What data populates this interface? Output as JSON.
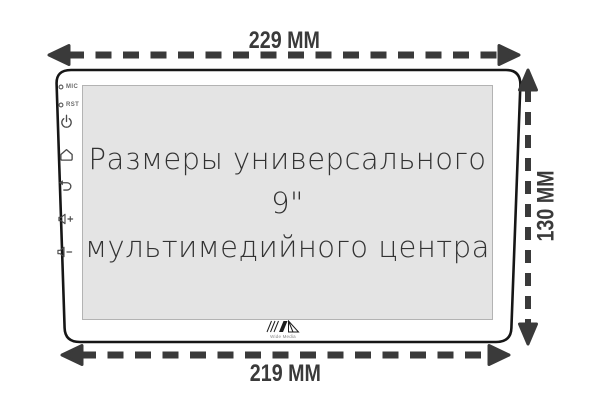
{
  "diagram": {
    "title": "Размеры универсального 9\" мультимедийного центра",
    "dimensions": {
      "top": "229 MM",
      "bottom": "219 MM",
      "right": "130 MM"
    },
    "screen_caption": {
      "line1": "Размеры универсального 9\"",
      "line2": "мультимедийного центра"
    },
    "bezel": {
      "mic_label": "MIC",
      "rst_label": "RST",
      "icons": [
        "mic-led",
        "reset-led",
        "power",
        "home",
        "back",
        "volume-up",
        "volume-down"
      ]
    },
    "logo": {
      "text": "Wide Media"
    },
    "colors": {
      "dimension": "#3a3a3a",
      "device_outline": "#161616",
      "screen_fill": "#e4e4e4",
      "screen_border": "#b3b3b3",
      "caption_text": "#323232",
      "icon": "#4a4a4a"
    }
  }
}
